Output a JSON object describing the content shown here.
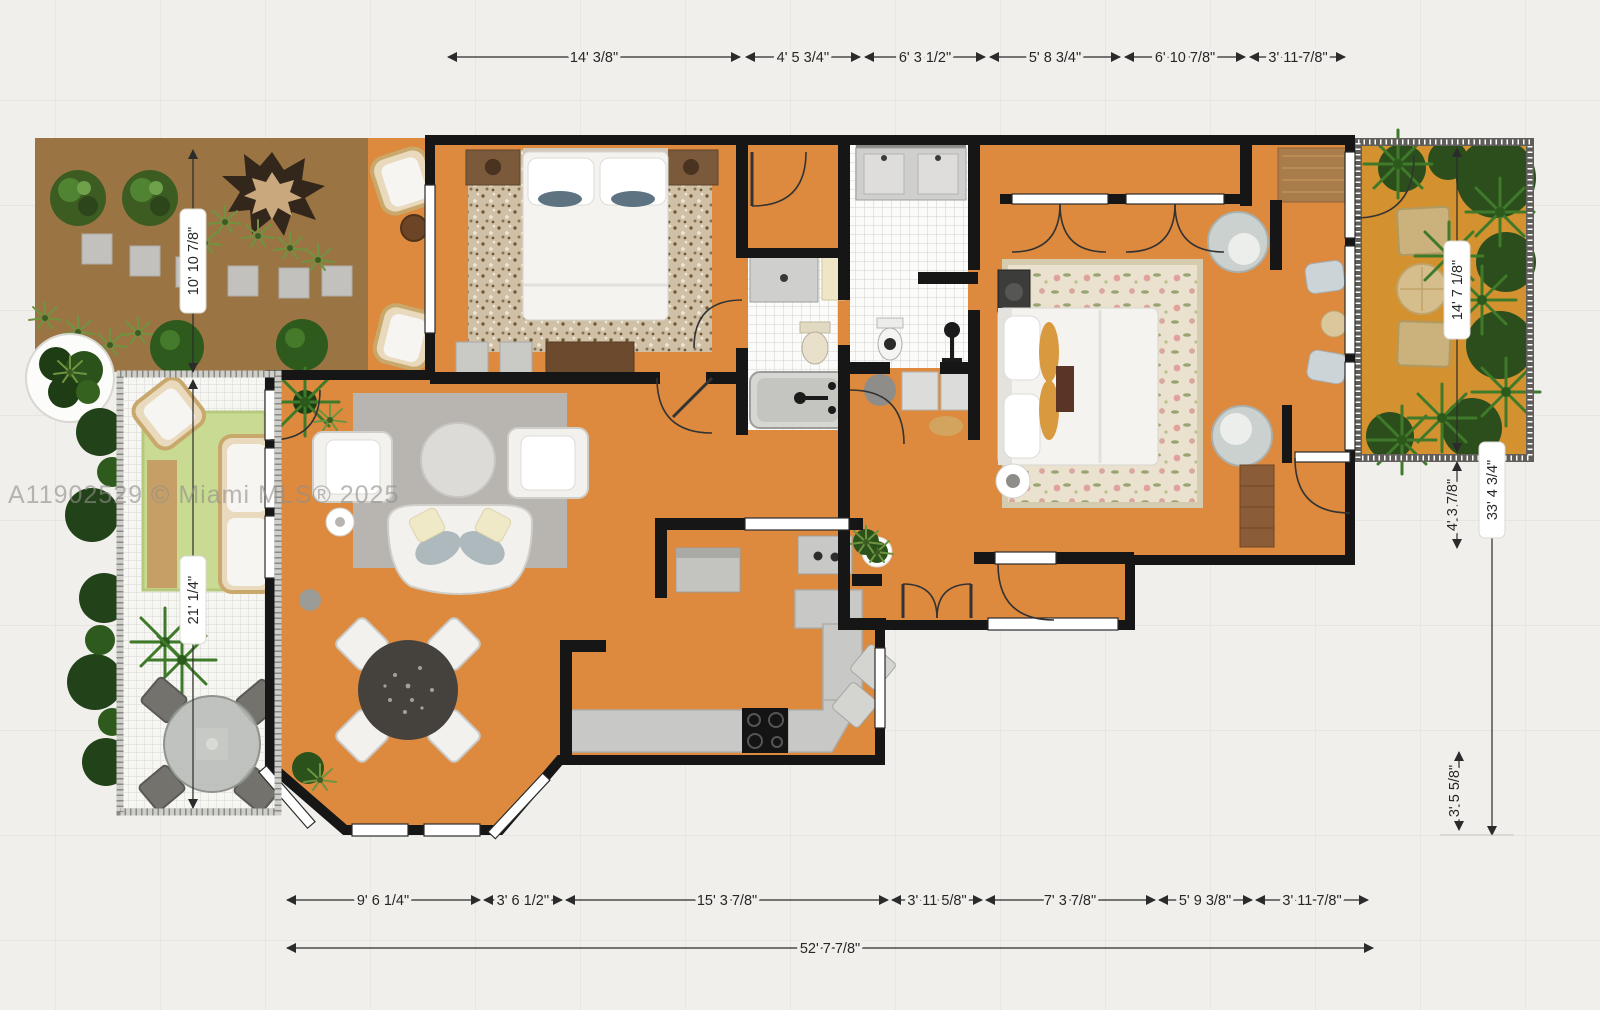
{
  "watermark": {
    "text": "A11902529 © Miami MLS® 2025"
  },
  "colors": {
    "background": "#f0efeb",
    "grid_line": "#e3e2de",
    "wall": "#161616",
    "floor_orange": "#dd8a3e",
    "balcony_floor": "#d3912f",
    "terrace_brown": "#9a7543",
    "tile_white": "#fbfbfa",
    "patio_floor": "#f6f6f3",
    "counter_gray": "#c8c8c6",
    "living_rug_gray": "#b8b5b1",
    "bedroom_rug_tan": "#cfc0a6",
    "master_rug_cream": "#eae2cf",
    "patio_rug_green": "#c9da92",
    "dimension_text": "#262626"
  },
  "dimensions": {
    "top": [
      {
        "label": "14' 3/8\""
      },
      {
        "label": "4' 5 3/4''"
      },
      {
        "label": "6' 3 1/2\""
      },
      {
        "label": "5' 8 3/4\""
      },
      {
        "label": "6' 10 7/8\""
      },
      {
        "label": "3' 11 7/8\""
      }
    ],
    "bottom": [
      {
        "label": "9' 6 1/4\""
      },
      {
        "label": "3' 6 1/2''"
      },
      {
        "label": "15' 3 7/8\""
      },
      {
        "label": "3' 11 5/8\""
      },
      {
        "label": "7' 3 7/8\""
      },
      {
        "label": "5' 9 3/8\""
      },
      {
        "label": "3' 11 7/8\""
      }
    ],
    "bottom_total": {
      "label": "52' 7 7/8\""
    },
    "left": [
      {
        "label": "10' 10 7/8\""
      },
      {
        "label": "21' 1/4''"
      }
    ],
    "right": [
      {
        "label": "14' 7 1/8\""
      },
      {
        "label": "4' 3 7/8\""
      },
      {
        "label": "33' 4 3/4\""
      },
      {
        "label": "3' 5 5/8\""
      }
    ]
  }
}
